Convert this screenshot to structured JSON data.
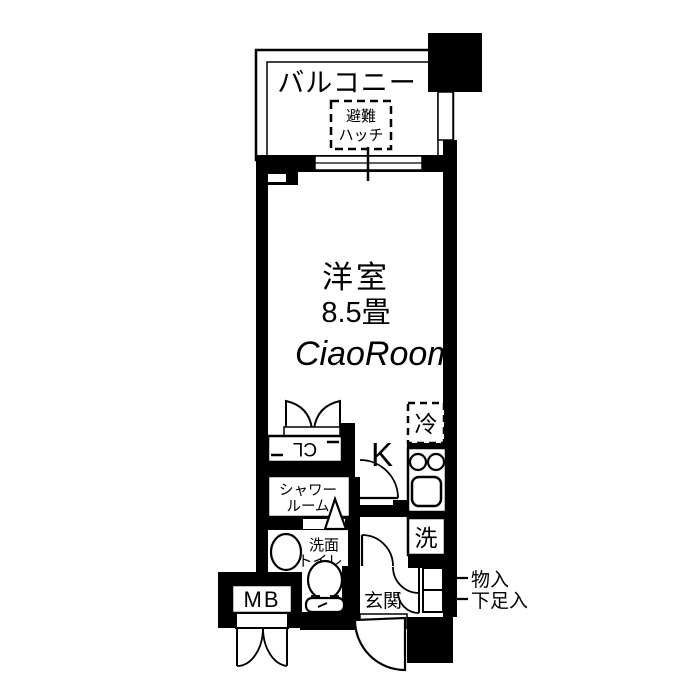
{
  "floorplan": {
    "balcony": {
      "label": "バルコニー",
      "hatch_line1": "避難",
      "hatch_line2": "ハッチ"
    },
    "main_room": {
      "label": "洋室",
      "size": "8.5畳"
    },
    "closet": {
      "label": "CL"
    },
    "kitchen": {
      "label": "K",
      "fridge": "冷"
    },
    "shower": {
      "label_line1": "シャワー",
      "label_line2": "ルーム"
    },
    "washroom": {
      "label_line1": "洗面",
      "label_line2": "トイレ"
    },
    "laundry": {
      "label": "洗"
    },
    "meter_box": {
      "label": "MB"
    },
    "entrance": {
      "label": "玄関"
    },
    "storage": {
      "label": "物入"
    },
    "shoe_cabinet": {
      "label": "下足入"
    },
    "watermark": {
      "text": "CiaoRoom"
    },
    "colors": {
      "wall": "#000000",
      "background": "#ffffff",
      "watermark": "#ededed"
    }
  }
}
